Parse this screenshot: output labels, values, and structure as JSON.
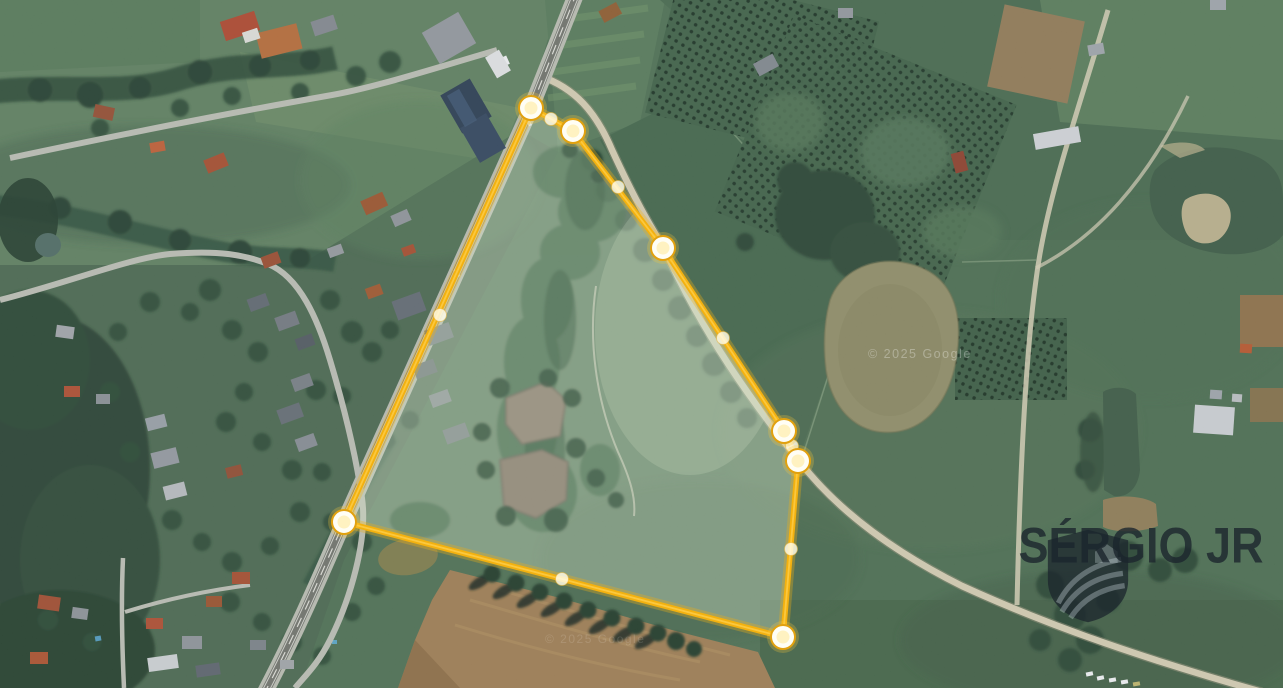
{
  "map": {
    "type": "satellite-imagery",
    "copyright_watermark": "© 2025 Google"
  },
  "parcel_overlay": {
    "stroke_color": "#F3AC00",
    "glow_color": "rgba(243,172,0,0.32)",
    "fill_tint": "rgba(223,236,207,0.30)",
    "vertices": [
      [
        531,
        108
      ],
      [
        573,
        131
      ],
      [
        663,
        248
      ],
      [
        784,
        431
      ],
      [
        798,
        461
      ],
      [
        783,
        637
      ],
      [
        344,
        522
      ]
    ],
    "midpoints": [
      [
        551,
        119
      ],
      [
        618,
        187
      ],
      [
        723,
        338
      ],
      [
        792,
        446
      ],
      [
        791,
        549
      ],
      [
        562,
        579
      ],
      [
        440,
        315
      ]
    ]
  },
  "brand_watermark": {
    "name": "SÉRGIO JR",
    "logo_icon": "shield-crest-icon",
    "color": "rgba(27,37,45,0.80)"
  }
}
